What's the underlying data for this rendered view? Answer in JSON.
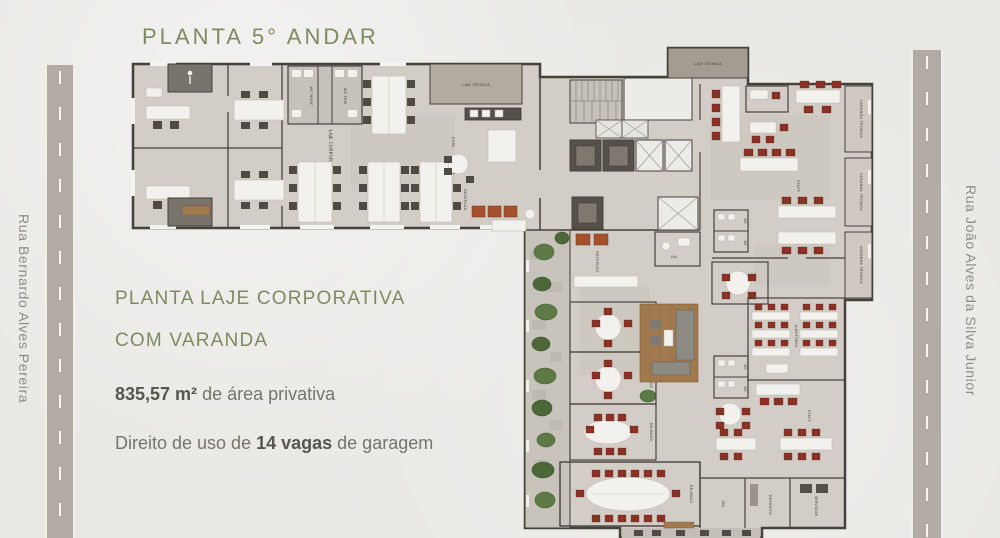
{
  "title": "PLANTA 5° ANDAR",
  "streets": {
    "left": "Rua Bernardo Alves Pereira",
    "right": "Rua João Alves da Silva Junior"
  },
  "description": {
    "line1": "PLANTA LAJE CORPORATIVA",
    "line2": "COM VARANDA",
    "area_value": "835,57 m²",
    "area_suffix": " de área privativa",
    "garage_prefix": "Direito de uso de ",
    "garage_value": "14 vagas",
    "garage_suffix": " de garagem"
  },
  "plan": {
    "labels": {
      "laje_corporativa": "LAJE CORPORATIVA",
      "laje_tecnica": "LAJE TÉCNICA",
      "wc_masc": "WC MASC",
      "wc_fem": "WC FEM",
      "wc": "WC",
      "copa": "COPA",
      "recepcao": "RECEPÇÃO",
      "varanda_tecnica": "VARANDA TÉCNICA",
      "staff": "STAFF",
      "auditorio": "AUDITÓRIO",
      "reuniao": "REUNIÃO",
      "lav": "LAV.",
      "dml": "DML",
      "deposito": "DEPÓSITO",
      "servidor": "SERVIDOR"
    },
    "colors": {
      "accent_green": "#7e8b60",
      "text_gray": "#75746e",
      "background": "#e9e8e5",
      "road": "#b2aba3",
      "wall": "#45413b",
      "floor": "#d2cec7",
      "chair_red": "#8a3226",
      "armchair_rust": "#a5512e",
      "plant_green": "#5d7a46",
      "wood": "#a07a4e"
    }
  }
}
